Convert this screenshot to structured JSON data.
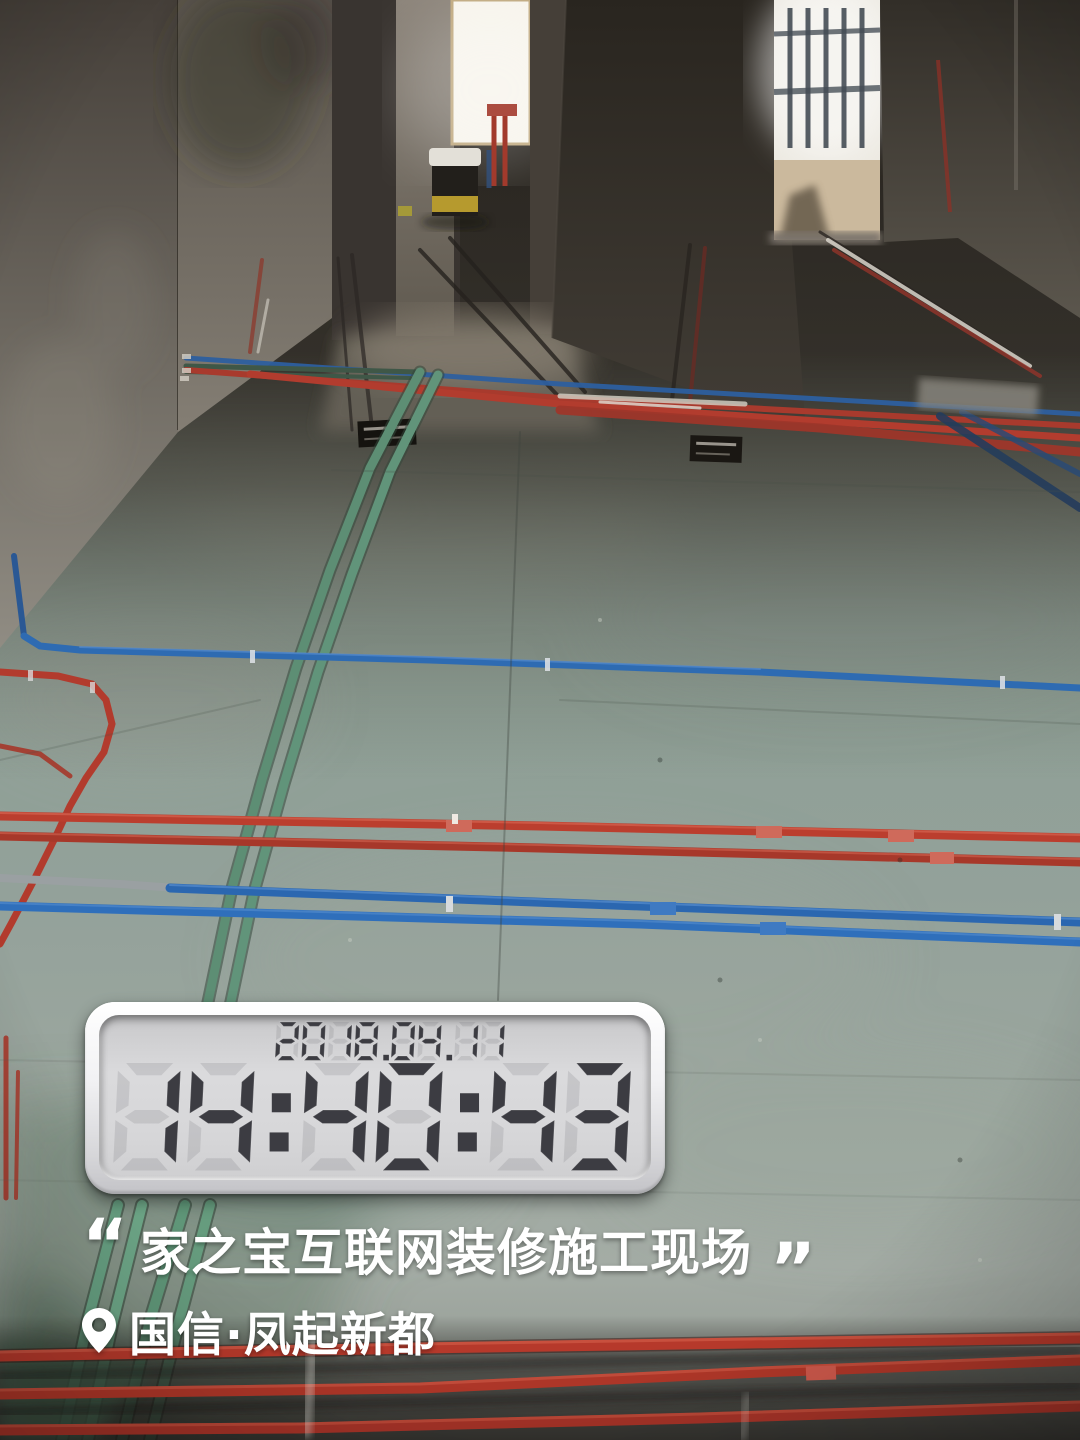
{
  "photo": {
    "description": "Unfinished apartment interior during renovation; red, blue and green electrical conduit pipes laid across a green-grey concrete floor; bright window and balcony doorway at far end",
    "colors": {
      "pipe_red": "#b23b2d",
      "pipe_blue": "#2e6bb2",
      "pipe_green": "#5d8e74",
      "floor": "#93a19a",
      "wall_dark": "#36322c",
      "window_light": "#f7f4ec",
      "lcd_digit": "#3c3c42",
      "lcd_panel": "#d6d6d8",
      "overlay_text": "#ffffff"
    }
  },
  "timestamp_widget": {
    "date": "2018.04.11",
    "time": "14:40:43"
  },
  "caption": {
    "quote_open": "“",
    "text": "家之宝互联网装修施工现场",
    "quote_close": "”"
  },
  "location": {
    "name": "国信·凤起新都"
  }
}
